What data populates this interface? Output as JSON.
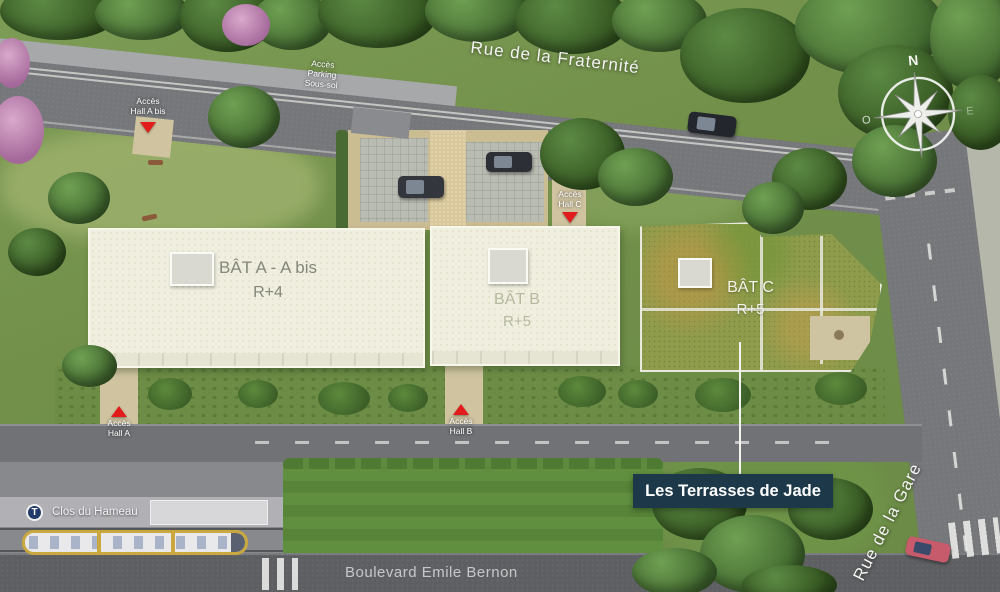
{
  "project": {
    "name": "Les Terrasses de Jade"
  },
  "streets": {
    "fraternite": "Rue de la Fraternité",
    "gare": "Rue de la Gare",
    "bernon": "Boulevard Emile Bernon"
  },
  "buildings": {
    "a": {
      "name": "BÂT A - A bis",
      "floors": "R+4"
    },
    "b": {
      "name": "BÂT B",
      "floors": "R+5"
    },
    "c": {
      "name": "BÂT C",
      "floors": "R+5"
    }
  },
  "access": {
    "parking": {
      "l1": "Accès",
      "l2": "Parking",
      "l3": "Sous-sol"
    },
    "hall_a_bis": {
      "l1": "Accès",
      "l2": "Hall A bis"
    },
    "hall_a": {
      "l1": "Accès",
      "l2": "Hall A"
    },
    "hall_b": {
      "l1": "Accès",
      "l2": "Hall B"
    },
    "hall_c": {
      "l1": "Accès",
      "l2": "Hall C"
    }
  },
  "transit": {
    "badge": "T",
    "stop": "Clos du Hameau"
  },
  "compass": {
    "north": "N",
    "west": "O",
    "east": "E"
  },
  "colors": {
    "accent_red": "#e21b1b",
    "label_bg": "#1d3949",
    "roof_cream": "#efeedf",
    "roof_green": "#8f9c4c",
    "road_gray": "#76777a"
  }
}
